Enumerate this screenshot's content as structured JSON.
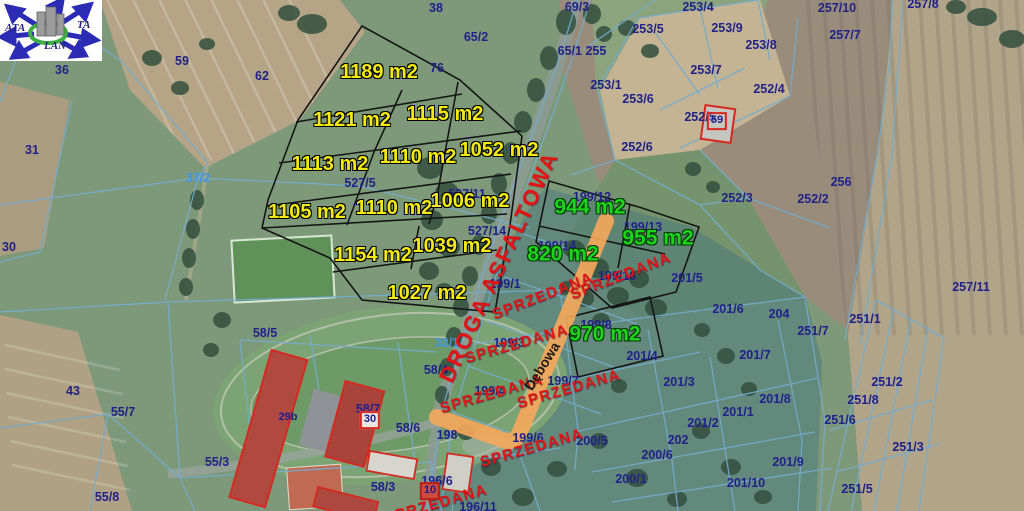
{
  "logo": {
    "text_left": "ATA",
    "text_right": "TA",
    "text_bottom": "LAN"
  },
  "colors": {
    "area_yellow": "#f2ea10",
    "area_green": "#1bd41b",
    "sold_red": "#e31414",
    "parcel_navy": "#21218a",
    "parcel_light_blue": "#3e97e8",
    "highlight_road_orange": "#f3a75b",
    "boundary_black": "#151515",
    "cadastral_blue": "#74accf"
  },
  "map": {
    "road_label": {
      "t": "DROGA ASFALTOWA",
      "x": 499,
      "y": 267,
      "r": -65
    },
    "street_label": {
      "t": "Dębowa",
      "x": 542,
      "y": 366,
      "r": -58
    },
    "area_labels_yellow": [
      {
        "t": "1189 m2",
        "x": 379,
        "y": 72
      },
      {
        "t": "1121 m2",
        "x": 352,
        "y": 120
      },
      {
        "t": "1115 m2",
        "x": 445,
        "y": 114
      },
      {
        "t": "1113 m2",
        "x": 330,
        "y": 164
      },
      {
        "t": "1110 m2",
        "x": 418,
        "y": 157
      },
      {
        "t": "1052 m2",
        "x": 499,
        "y": 150
      },
      {
        "t": "1105 m2",
        "x": 307,
        "y": 212
      },
      {
        "t": "1110 m2",
        "x": 394,
        "y": 208
      },
      {
        "t": "1006 m2",
        "x": 470,
        "y": 201
      },
      {
        "t": "1154 m2",
        "x": 373,
        "y": 255
      },
      {
        "t": "1039 m2",
        "x": 452,
        "y": 246
      },
      {
        "t": "1027 m2",
        "x": 427,
        "y": 293
      }
    ],
    "area_labels_green": [
      {
        "t": "944 m2",
        "x": 590,
        "y": 207
      },
      {
        "t": "955 m2",
        "x": 658,
        "y": 238
      },
      {
        "t": "820 m2",
        "x": 563,
        "y": 254
      },
      {
        "t": "970 m2",
        "x": 605,
        "y": 334
      }
    ],
    "sold_labels": [
      {
        "t": "SPRZEDANA",
        "x": 543,
        "y": 296,
        "r": -21
      },
      {
        "t": "SPRZEDANA",
        "x": 621,
        "y": 276,
        "r": -21
      },
      {
        "t": "SPRZEDANA",
        "x": 517,
        "y": 344,
        "r": -16
      },
      {
        "t": "SPRZEDANA",
        "x": 492,
        "y": 394,
        "r": -16
      },
      {
        "t": "SPRZEDANA",
        "x": 569,
        "y": 389,
        "r": -16
      },
      {
        "t": "SPRZEDANA",
        "x": 532,
        "y": 448,
        "r": -16
      },
      {
        "t": "SPRZEDANA",
        "x": 436,
        "y": 504,
        "r": -16
      }
    ],
    "parcel_numbers": [
      {
        "t": "38",
        "x": 436,
        "y": 8
      },
      {
        "t": "36",
        "x": 62,
        "y": 70
      },
      {
        "t": "59",
        "x": 182,
        "y": 61
      },
      {
        "t": "62",
        "x": 262,
        "y": 76
      },
      {
        "t": "76",
        "x": 437,
        "y": 68
      },
      {
        "t": "31",
        "x": 32,
        "y": 150
      },
      {
        "t": "30",
        "x": 9,
        "y": 247
      },
      {
        "t": "43",
        "x": 73,
        "y": 391
      },
      {
        "t": "65/2",
        "x": 476,
        "y": 37
      },
      {
        "t": "65/1 255",
        "x": 582,
        "y": 51
      },
      {
        "t": "69/3",
        "x": 577,
        "y": 7
      },
      {
        "t": "253/4",
        "x": 698,
        "y": 7
      },
      {
        "t": "253/9",
        "x": 727,
        "y": 28
      },
      {
        "t": "253/5",
        "x": 648,
        "y": 29
      },
      {
        "t": "253/8",
        "x": 761,
        "y": 45
      },
      {
        "t": "253/7",
        "x": 706,
        "y": 70
      },
      {
        "t": "253/1",
        "x": 606,
        "y": 85
      },
      {
        "t": "253/6",
        "x": 638,
        "y": 99
      },
      {
        "t": "252/4",
        "x": 769,
        "y": 89
      },
      {
        "t": "252/5",
        "x": 700,
        "y": 117
      },
      {
        "t": "252/6",
        "x": 637,
        "y": 147
      },
      {
        "t": "252/3",
        "x": 737,
        "y": 198
      },
      {
        "t": "252/2",
        "x": 813,
        "y": 199
      },
      {
        "t": "256",
        "x": 841,
        "y": 182
      },
      {
        "t": "257/10",
        "x": 837,
        "y": 8
      },
      {
        "t": "257/7",
        "x": 845,
        "y": 35
      },
      {
        "t": "257/8",
        "x": 923,
        "y": 4
      },
      {
        "t": "257/11",
        "x": 971,
        "y": 287
      },
      {
        "t": "251/1",
        "x": 865,
        "y": 319
      },
      {
        "t": "251/7",
        "x": 813,
        "y": 331
      },
      {
        "t": "251/2",
        "x": 887,
        "y": 382
      },
      {
        "t": "251/8",
        "x": 863,
        "y": 400
      },
      {
        "t": "251/6",
        "x": 840,
        "y": 420
      },
      {
        "t": "251/3",
        "x": 908,
        "y": 447
      },
      {
        "t": "251/5",
        "x": 857,
        "y": 489
      },
      {
        "t": "204",
        "x": 779,
        "y": 314
      },
      {
        "t": "201/5",
        "x": 687,
        "y": 278
      },
      {
        "t": "201/6",
        "x": 728,
        "y": 309
      },
      {
        "t": "201/7",
        "x": 755,
        "y": 355
      },
      {
        "t": "201/4",
        "x": 642,
        "y": 356
      },
      {
        "t": "201/3",
        "x": 679,
        "y": 382
      },
      {
        "t": "201/8",
        "x": 775,
        "y": 399
      },
      {
        "t": "201/1",
        "x": 738,
        "y": 412
      },
      {
        "t": "201/2",
        "x": 703,
        "y": 423
      },
      {
        "t": "201/9",
        "x": 788,
        "y": 462
      },
      {
        "t": "201/10",
        "x": 746,
        "y": 483
      },
      {
        "t": "202",
        "x": 678,
        "y": 440
      },
      {
        "t": "200/5",
        "x": 592,
        "y": 441
      },
      {
        "t": "200/6",
        "x": 657,
        "y": 455
      },
      {
        "t": "200/1",
        "x": 631,
        "y": 479
      },
      {
        "t": "199/12",
        "x": 592,
        "y": 197
      },
      {
        "t": "199/13",
        "x": 643,
        "y": 227
      },
      {
        "t": "199/14",
        "x": 557,
        "y": 246
      },
      {
        "t": "199/16",
        "x": 617,
        "y": 276
      },
      {
        "t": "199/1",
        "x": 505,
        "y": 284
      },
      {
        "t": "199/8",
        "x": 596,
        "y": 325
      },
      {
        "t": "199/3",
        "x": 509,
        "y": 343
      },
      {
        "t": "199/7",
        "x": 563,
        "y": 381
      },
      {
        "t": "199/4",
        "x": 490,
        "y": 391
      },
      {
        "t": "199/6",
        "x": 528,
        "y": 438
      },
      {
        "t": "198",
        "x": 447,
        "y": 435
      },
      {
        "t": "58/5",
        "x": 265,
        "y": 333
      },
      {
        "t": "58/4",
        "x": 436,
        "y": 370
      },
      {
        "t": "58/7",
        "x": 368,
        "y": 409
      },
      {
        "t": "58/6",
        "x": 408,
        "y": 428
      },
      {
        "t": "58/3",
        "x": 383,
        "y": 487
      },
      {
        "t": "196/6",
        "x": 437,
        "y": 481
      },
      {
        "t": "196/11",
        "x": 478,
        "y": 507
      },
      {
        "t": "55/7",
        "x": 123,
        "y": 412
      },
      {
        "t": "55/3",
        "x": 217,
        "y": 462
      },
      {
        "t": "55/8",
        "x": 107,
        "y": 497
      },
      {
        "t": "527/5",
        "x": 360,
        "y": 183
      },
      {
        "t": "527/11",
        "x": 467,
        "y": 194
      },
      {
        "t": "527/14",
        "x": 487,
        "y": 231
      }
    ],
    "parcel_numbers_light": [
      {
        "t": "37/2",
        "x": 198,
        "y": 178
      },
      {
        "t": "32/1",
        "x": 447,
        "y": 343
      }
    ],
    "building_badges": [
      {
        "t": "59",
        "x": 717,
        "y": 121,
        "style": "open"
      },
      {
        "t": "29b",
        "x": 288,
        "y": 418,
        "style": "plain"
      },
      {
        "t": "30",
        "x": 370,
        "y": 420,
        "style": "white"
      },
      {
        "t": "10",
        "x": 430,
        "y": 491,
        "style": "red"
      }
    ]
  }
}
